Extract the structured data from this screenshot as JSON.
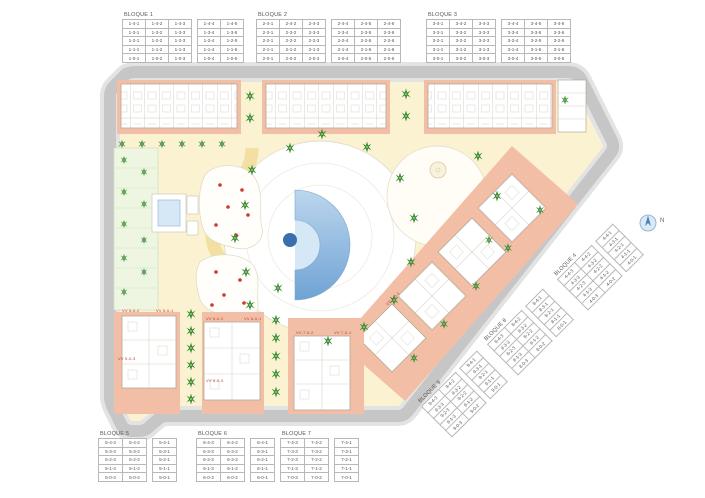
{
  "colors": {
    "road-gray": "#c6c6c6",
    "sidewalk-gray": "#e3e3e3",
    "interior-cream": "#fbf2d2",
    "path-yellow": "#f3dfa2",
    "plot-salmon": "#f2bfa6",
    "pool-blue": "#8cb7de",
    "pool-dark": "#3a6fae",
    "tree-green": "#3d8a3c",
    "umbrella-red": "#cc3a30",
    "label-red": "#c0392b"
  },
  "blocks": [
    {
      "label": "BLOQUE 1",
      "groups": [
        {
          "rows": [
            [
              "1-4-1",
              "1-4-2",
              "1-4-3"
            ],
            [
              "1-3-1",
              "1-3-2",
              "1-3-3"
            ],
            [
              "1-2-1",
              "1-2-2",
              "1-2-3"
            ],
            [
              "1-1-1",
              "1-1-2",
              "1-1-3"
            ],
            [
              "1-0-1",
              "1-0-2",
              "1-0-3"
            ]
          ]
        },
        {
          "rows": [
            [
              "1-4-4",
              "1-4-5"
            ],
            [
              "1-3-4",
              "1-3-5"
            ],
            [
              "1-2-4",
              "1-2-5"
            ],
            [
              "1-1-4",
              "1-1-5"
            ],
            [
              "1-0-4",
              "1-0-5"
            ]
          ]
        }
      ]
    },
    {
      "label": "BLOQUE 2",
      "groups": [
        {
          "rows": [
            [
              "2-4-1",
              "2-4-2",
              "2-4-3"
            ],
            [
              "2-3-1",
              "2-3-2",
              "2-3-3"
            ],
            [
              "2-2-1",
              "2-2-2",
              "2-2-3"
            ],
            [
              "2-1-1",
              "2-1-2",
              "2-1-3"
            ],
            [
              "2-0-1",
              "2-0-2",
              "2-0-3"
            ]
          ]
        },
        {
          "rows": [
            [
              "2-4-4",
              "2-4-5",
              "2-4-6"
            ],
            [
              "2-3-4",
              "2-3-5",
              "2-3-6"
            ],
            [
              "2-2-4",
              "2-2-5",
              "2-2-6"
            ],
            [
              "2-1-4",
              "2-1-5",
              "2-1-6"
            ],
            [
              "2-0-4",
              "2-0-5",
              "2-0-6"
            ]
          ]
        }
      ]
    },
    {
      "label": "BLOQUE 3",
      "groups": [
        {
          "rows": [
            [
              "3-4-1",
              "3-4-2",
              "3-4-3"
            ],
            [
              "3-3-1",
              "3-3-2",
              "3-3-3"
            ],
            [
              "3-2-1",
              "3-2-2",
              "3-2-3"
            ],
            [
              "3-1-1",
              "3-1-2",
              "3-1-3"
            ],
            [
              "3-0-1",
              "3-0-2",
              "3-0-3"
            ]
          ]
        },
        {
          "rows": [
            [
              "3-4-4",
              "3-4-5",
              "3-4-6"
            ],
            [
              "3-3-4",
              "3-3-5",
              "3-3-6"
            ],
            [
              "3-2-4",
              "3-2-5",
              "3-2-6"
            ],
            [
              "3-1-4",
              "3-1-5",
              "3-1-6"
            ],
            [
              "3-0-4",
              "3-0-5",
              "3-0-6"
            ]
          ]
        }
      ]
    },
    {
      "label": "BLOQUE 4",
      "groups": [
        {
          "rows": [
            [
              "4-4-3",
              "4-4-2"
            ],
            [
              "4-3-3",
              "4-3-2"
            ],
            [
              "4-2-3",
              "4-2-2"
            ],
            [
              "4-1-3",
              "4-1-2"
            ],
            [
              "4-0-3",
              "4-0-2"
            ]
          ]
        },
        {
          "rows": [
            [
              "4-4-1"
            ],
            [
              "4-3-1"
            ],
            [
              "4-2-1"
            ],
            [
              "4-1-1"
            ],
            [
              "4-0-1"
            ]
          ]
        }
      ]
    },
    {
      "label": "BLOQUE 5",
      "groups": [
        {
          "rows": [
            [
              "5-4-3",
              "5-4-2"
            ],
            [
              "5-3-3",
              "5-3-2"
            ],
            [
              "5-2-3",
              "5-2-2"
            ],
            [
              "5-1-3",
              "5-1-2"
            ],
            [
              "5-0-3",
              "5-0-2"
            ]
          ]
        },
        {
          "rows": [
            [
              "5-4-1"
            ],
            [
              "5-3-1"
            ],
            [
              "5-2-1"
            ],
            [
              "5-1-1"
            ],
            [
              "5-0-1"
            ]
          ]
        }
      ]
    },
    {
      "label": "BLOQUE 6",
      "groups": [
        {
          "rows": [
            [
              "6-4-3",
              "6-4-2"
            ],
            [
              "6-3-3",
              "6-3-2"
            ],
            [
              "6-2-3",
              "6-2-2"
            ],
            [
              "6-1-3",
              "6-1-2"
            ],
            [
              "6-0-3",
              "6-0-2"
            ]
          ]
        },
        {
          "rows": [
            [
              "6-4-1"
            ],
            [
              "6-3-1"
            ],
            [
              "6-2-1"
            ],
            [
              "6-1-1"
            ],
            [
              "6-0-1"
            ]
          ]
        }
      ]
    },
    {
      "label": "BLOQUE 7",
      "groups": [
        {
          "rows": [
            [
              "7-4-3",
              "7-4-2"
            ],
            [
              "7-3-3",
              "7-3-2"
            ],
            [
              "7-2-3",
              "7-2-2"
            ],
            [
              "7-1-3",
              "7-1-2"
            ],
            [
              "7-0-3",
              "7-0-2"
            ]
          ]
        },
        {
          "rows": [
            [
              "7-4-1"
            ],
            [
              "7-3-1"
            ],
            [
              "7-2-1"
            ],
            [
              "7-1-1"
            ],
            [
              "7-0-1"
            ]
          ]
        }
      ]
    },
    {
      "label": "BLOQUE 8",
      "groups": [
        {
          "rows": [
            [
              "8-4-3",
              "8-4-2"
            ],
            [
              "8-3-3",
              "8-3-2"
            ],
            [
              "8-2-3",
              "8-2-2"
            ],
            [
              "8-1-3",
              "8-1-2"
            ],
            [
              "8-0-3",
              "8-0-2"
            ]
          ]
        },
        {
          "rows": [
            [
              "8-4-1"
            ],
            [
              "8-3-1"
            ],
            [
              "8-2-1"
            ],
            [
              "8-1-1"
            ],
            [
              "8-0-1"
            ]
          ]
        }
      ]
    },
    {
      "label": "BLOQUE 9",
      "groups": [
        {
          "rows": [
            [
              "9-4-3",
              "9-4-2"
            ],
            [
              "9-3-3",
              "9-3-2"
            ],
            [
              "9-2-3",
              "9-2-2"
            ],
            [
              "9-1-3",
              "9-1-2"
            ],
            [
              "9-0-3",
              "9-0-2"
            ]
          ]
        },
        {
          "rows": [
            [
              "9-4-1"
            ],
            [
              "9-3-1"
            ],
            [
              "9-2-1"
            ],
            [
              "9-1-1"
            ],
            [
              "9-0-1"
            ]
          ]
        }
      ]
    }
  ],
  "unit_labels": [
    "VV 5-0-2",
    "VV 5-0-1",
    "VV 5-0-3",
    "VV 6-0-2",
    "VV 6-0-1",
    "VV 6-0-3",
    "VV 7-0-2",
    "VV 7-0-1",
    "VV 4-0-1"
  ],
  "compass": {
    "label": "N"
  }
}
